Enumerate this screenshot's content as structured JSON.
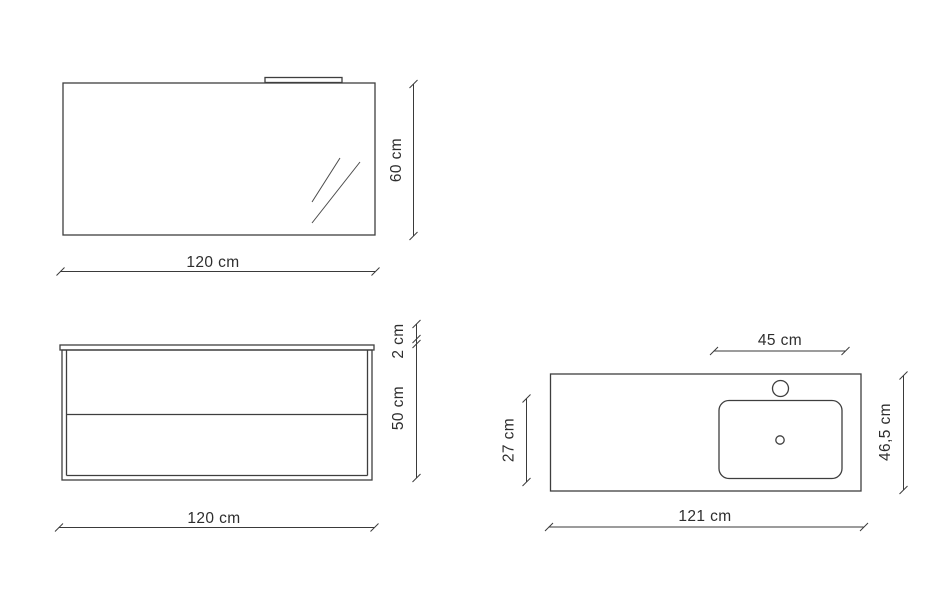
{
  "page": {
    "background_color": "#ffffff",
    "line_color": "#3e3e3e",
    "text_color": "#2e2e2e"
  },
  "views": {
    "mirror_front": {
      "title": "mirror-front-view",
      "width_label": "120 cm",
      "height_label": "60 cm"
    },
    "cabinet_front": {
      "title": "cabinet-front-view",
      "top_thickness_label": "2 cm",
      "height_label": "50 cm",
      "width_label": "120 cm"
    },
    "washbasin_top": {
      "title": "washbasin-top-view",
      "basin_width_label": "45 cm",
      "basin_depth_label": "27 cm",
      "depth_label": "46,5 cm",
      "width_label": "121 cm"
    }
  }
}
